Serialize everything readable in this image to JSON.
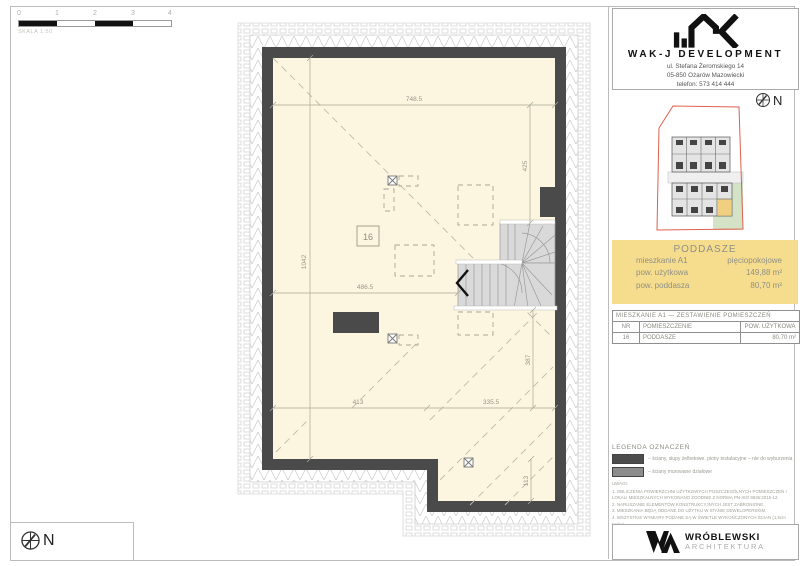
{
  "scalebar": {
    "ticks": [
      "0",
      "1",
      "2",
      "3",
      "4"
    ],
    "label": "SKALA 1:50"
  },
  "compass": {
    "label": "N"
  },
  "plan": {
    "room_number": "16",
    "dims": {
      "top": "748.5",
      "right_top": "425",
      "left": "1042",
      "mid": "486.5",
      "bottom_left": "413",
      "bottom_right": "335.5",
      "right_mid": "387",
      "right_bottom": "113"
    }
  },
  "developer": {
    "name": "WAK-J DEVELOPMENT",
    "address_line1": "ul. Stefana Żeromskiego 14",
    "address_line2": "05-850 Ożarów Mazowiecki",
    "address_line3": "telefon: 573 414 444"
  },
  "unit_card": {
    "title": "PODDASZE",
    "rows": [
      {
        "label": "mieszkanie A1",
        "value": "pięciopokojowe"
      },
      {
        "label": "pow. użytkowa",
        "value": "149,88 m²"
      },
      {
        "label": "pow. poddasza",
        "value": "80,70 m²"
      }
    ],
    "bg_color": "#f6dd8e"
  },
  "rooms_table": {
    "title": "MIESZKANIE A1 — ZESTAWIENIE POMIESZCZEŃ",
    "columns": [
      "NR",
      "POMIESZCZENIE",
      "POW. UŻYTKOWA"
    ],
    "rows": [
      {
        "nr": "16",
        "room": "PODDASZE",
        "area": "80,70 m²"
      }
    ]
  },
  "legend": {
    "title": "LEGENDA OZNACZEŃ",
    "items": [
      {
        "label": "– ściany, słupy żelbetowe, piony instalacyjne – nie do wyburzenia",
        "color": "#4d4d4d"
      },
      {
        "label": "– ściany murowane działowe",
        "color": "#8c8c8c"
      }
    ]
  },
  "notes": {
    "title": "UWAGI:",
    "lines": [
      "1. OBLICZENIA POWIERZCHNI UŻYTKOWYCH POSZCZEGÓLNYCH POMIESZCZEŃ I LOKALI MIESZKALNYCH WYKONANO ZGODNIE Z NORMĄ PN-ISO 9836:2015-12.",
      "2. NARUSZANIE ELEMENTÓW KONSTRUKCYJNYCH JEST ZABRONIONE.",
      "3. MIESZKANIA BĘDĄ ODDANE DO UŻYTKU W STANIE DEWELOPERSKIM.",
      "4. WSZYSTKIE WYMIARY PODANE SĄ W ŚWIETLE WYKOŃCZONYCH ŚCIAN (1,5cm tynku).",
      "5. PODANE WYMIARY I POWIERZCHNIE ODNOSZĄ SIĘ DO PROJEKTÓW ARCHITEKTONICZNYCH."
    ]
  },
  "architect": {
    "name": "WRÓBLEWSKI",
    "sub": "ARCHITEKTURA"
  },
  "colors": {
    "wall": "#4a4a4a",
    "interior": "#fcf5df",
    "stairs": "#d9d9d9",
    "site_outline_red": "#e0604f",
    "site_green": "#d4e3c6",
    "unit_highlight": "#f0d080"
  }
}
